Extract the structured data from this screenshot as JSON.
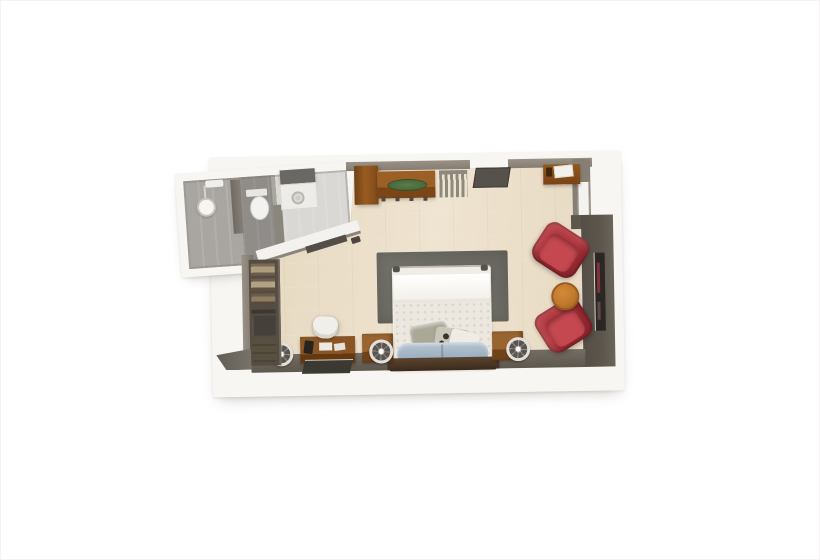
{
  "meta": {
    "title": "3D top-down floor plan render of a hotel guest room with bathroom",
    "style": "photographic isometric render, no visible text"
  },
  "palette": {
    "floor": "#e9dcc6",
    "floorLight": "#efe4d1",
    "wallWhite": "#f8f6f3",
    "wallGray": "#8a8276",
    "wallDark": "#5d564d",
    "wood": "#96591f",
    "woodDark": "#6e4215",
    "chairRed": "#af3039",
    "chairRedLight": "#c54750",
    "tableOrange": "#c07a2d",
    "rugGray": "#6f6e66",
    "bedWhite": "#f0ede6",
    "pillowBlue": "#9fb4c4",
    "bathTile": "#a9a6a2",
    "bathFloorLight": "#dad8d4",
    "trayGreen": "#4d6b3c",
    "matDark": "#57514a",
    "headboardBrown": "#46331f"
  },
  "rooms": [
    {
      "id": "bathroom",
      "label": "Bathroom",
      "fixtures": [
        "walk-in shower with showerhead",
        "glass partition",
        "toilet",
        "vanity with sink"
      ]
    },
    {
      "id": "bedroom",
      "label": "Guest room",
      "fixtures": [
        "bed with white duvet and blue pillows",
        "dark headboard",
        "two wood nightstands",
        "three round wall lamps",
        "gray area rug",
        "open closet with shelves and drawers",
        "writing desk with chair, phone and papers",
        "wardrobe cabinet",
        "wood credenza with green tray",
        "radiator",
        "entry door with dark mat",
        "corner shelf desk",
        "window",
        "two red armchairs",
        "round orange side table",
        "wall-mounted TV"
      ]
    }
  ]
}
